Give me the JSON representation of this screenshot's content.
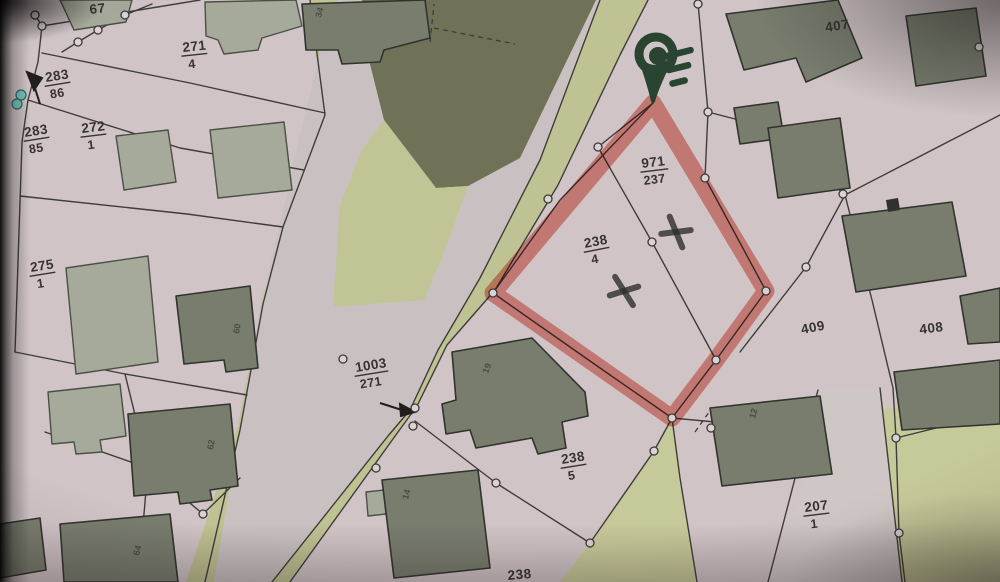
{
  "map": {
    "type": "cadastral-parcel-map-photo",
    "fraction_labels": [
      {
        "num": "271",
        "den": "4"
      },
      {
        "num": "283",
        "den": "86"
      },
      {
        "num": "283",
        "den": "85"
      },
      {
        "num": "272",
        "den": "1"
      },
      {
        "num": "275",
        "den": "1"
      },
      {
        "num": "1003",
        "den": "271"
      },
      {
        "num": "971",
        "den": "237"
      },
      {
        "num": "238",
        "den": "4"
      },
      {
        "num": "238",
        "den": "5"
      },
      {
        "num": "207",
        "den": "1"
      }
    ],
    "single_labels": [
      {
        "text": "67"
      },
      {
        "text": "407"
      },
      {
        "text": "409"
      },
      {
        "text": "408"
      },
      {
        "text": "238"
      }
    ],
    "building_numbers": [
      {
        "text": "34"
      },
      {
        "text": "60"
      },
      {
        "text": "62"
      },
      {
        "text": "64"
      },
      {
        "text": "19"
      },
      {
        "text": "14"
      },
      {
        "text": "12"
      }
    ],
    "marker": {
      "name": "location-pin-logo"
    },
    "colors": {
      "paper": "#D2C5C7",
      "highlight_red": "#EF6F63",
      "pin_green": "#1B3A24",
      "vegetation": "#C0C48E",
      "vegetation_dark": "#6F7254",
      "road": "#CBC2C2",
      "building_dark": "#787D6D",
      "building_light": "#A7AB99",
      "boundary_line": "#3E3C38",
      "point_teal": "#6FC9BE"
    }
  }
}
